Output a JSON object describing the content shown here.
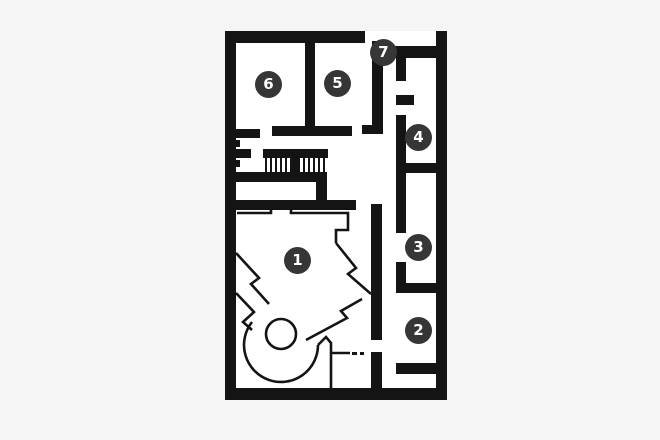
{
  "colors": {
    "background": "#f5f5f5",
    "floor": "#ffffff",
    "wall": "#141414",
    "marker_fill": "#363636",
    "marker_text": "#ffffff"
  },
  "floorplan": {
    "rooms": [
      {
        "id": "room-1",
        "label": "1"
      },
      {
        "id": "room-2",
        "label": "2"
      },
      {
        "id": "room-3",
        "label": "3"
      },
      {
        "id": "room-4",
        "label": "4"
      },
      {
        "id": "room-5",
        "label": "5"
      },
      {
        "id": "room-6",
        "label": "6"
      },
      {
        "id": "room-7",
        "label": "7"
      }
    ],
    "features": [
      {
        "name": "stairs-icon"
      },
      {
        "name": "spiral-ramp-outline"
      },
      {
        "name": "door-openings"
      }
    ]
  }
}
